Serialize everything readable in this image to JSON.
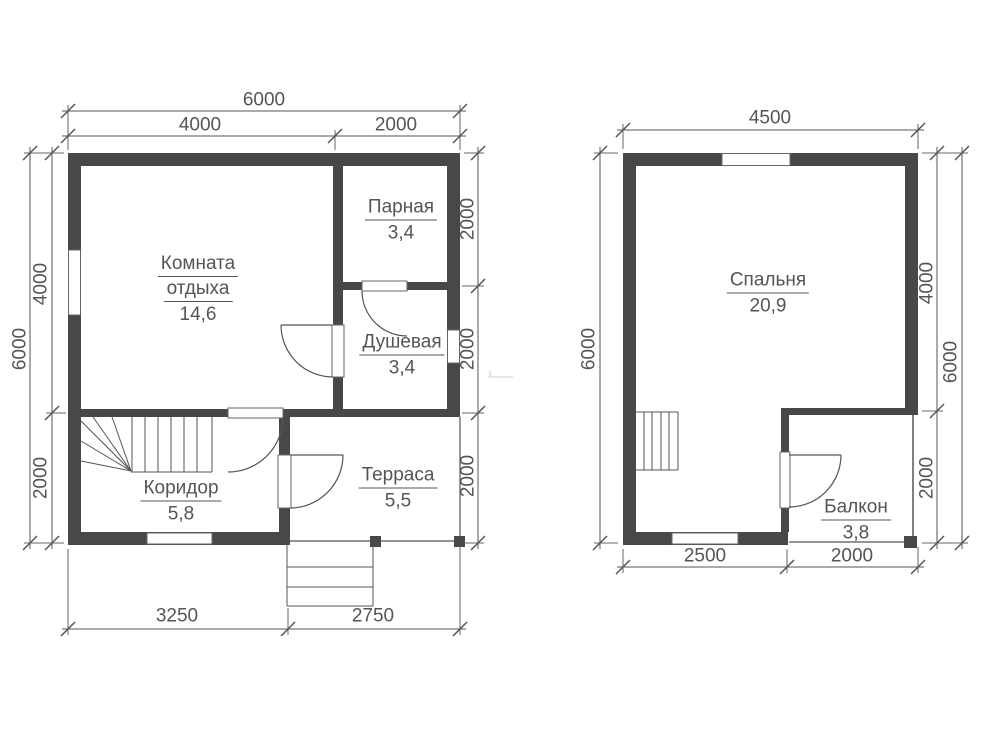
{
  "drawing": {
    "type": "floor-plan",
    "colors": {
      "wall": "#484848",
      "line": "#555555",
      "ext_line": "#666666",
      "text": "#555555"
    }
  },
  "floor1": {
    "rooms": {
      "rest": {
        "name1": "Комната",
        "name2": "отдыха",
        "area": "14,6"
      },
      "sauna": {
        "name": "Парная",
        "area": "3,4"
      },
      "shower": {
        "name": "Душевая",
        "area": "3,4"
      },
      "corridor": {
        "name": "Коридор",
        "area": "5,8"
      },
      "terrace": {
        "name": "Терраса",
        "area": "5,5"
      }
    },
    "dims": {
      "top_total": "6000",
      "top_left": "4000",
      "top_right": "2000",
      "left_total": "6000",
      "left_upper": "4000",
      "left_lower": "2000",
      "right_top": "2000",
      "right_mid": "2000",
      "right_bottom": "2000",
      "bottom_left": "3250",
      "bottom_right": "2750"
    }
  },
  "floor2": {
    "rooms": {
      "bedroom": {
        "name": "Спальня",
        "area": "20,9"
      },
      "balcony": {
        "name": "Балкон",
        "area": "3,8"
      }
    },
    "dims": {
      "top_total": "4500",
      "left_total": "6000",
      "right_upper": "4000",
      "right_lower": "2000",
      "right_total": "6000",
      "bottom_left": "2500",
      "bottom_right": "2000"
    }
  }
}
